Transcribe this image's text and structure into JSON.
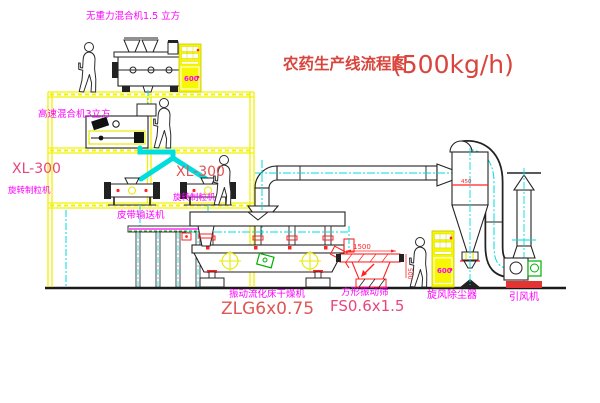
{
  "title": {
    "name": "农药生产线流程图",
    "capacity": "(500kg/h)"
  },
  "equipment": {
    "gravity_mixer": {
      "label": "无重力混合机1.5 立方"
    },
    "high_speed_mixer": {
      "label": "高速混合机3立方"
    },
    "granulator_left": {
      "model": "XL-300",
      "name": "旋转制粒机"
    },
    "granulator_right": {
      "model": "XL-300",
      "name": "旋转制粒机"
    },
    "belt_conveyor": {
      "label": "皮带输送机"
    },
    "fluid_bed_dryer": {
      "name": "振动流化床干燥机",
      "model": "ZLG6x0.75"
    },
    "vibrating_screen": {
      "name": "方形振动筛",
      "model": "FS0.6x1.5",
      "dim_width": "1500",
      "dim_height": "500"
    },
    "cyclone": {
      "name": "旋风除尘器",
      "marking": "450"
    },
    "induced_draft_fan": {
      "name": "引风机"
    },
    "control_cabinet_top": {
      "marking": "600"
    },
    "control_cabinet_bottom": {
      "marking": "600"
    }
  },
  "colors": {
    "title_red": "#d9453c",
    "model_red": "#e05555",
    "model_pink": "#e8457f",
    "label_magenta": "#ff00ff",
    "dim_red": "#ff2222",
    "structure_yellow": "#f2f200",
    "centerline_cyan": "#00dddd",
    "detail_green": "#00b000"
  }
}
